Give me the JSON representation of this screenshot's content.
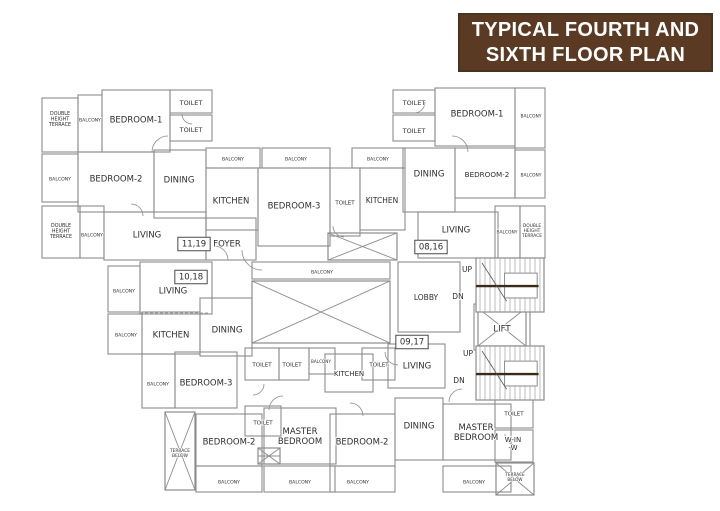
{
  "title": {
    "line1": "TYPICAL FOURTH AND",
    "line2": "SIXTH FLOOR PLAN",
    "bg": "#5a3a22",
    "fg": "#ffffff"
  },
  "plan": {
    "colors": {
      "wall": "#8c8c8c",
      "hatch": "#a3a3a3",
      "text": "#2e2e2e",
      "landing": "#3e2b17",
      "box_border": "#4a4a4a"
    },
    "rooms": [
      {
        "n": "tl-terrace-1",
        "r": [
          42,
          98,
          36,
          54
        ]
      },
      {
        "n": "tl-balcony-1",
        "r": [
          78,
          95,
          24,
          57
        ]
      },
      {
        "n": "tl-bedroom-1",
        "r": [
          102,
          90,
          68,
          62
        ]
      },
      {
        "n": "tl-toilet-1",
        "r": [
          170,
          90,
          42,
          23
        ]
      },
      {
        "n": "tl-toilet-2",
        "r": [
          170,
          115,
          42,
          26
        ]
      },
      {
        "n": "tl-balcony-2",
        "r": [
          42,
          154,
          36,
          48
        ]
      },
      {
        "n": "tl-bedroom-2",
        "r": [
          78,
          152,
          76,
          60
        ]
      },
      {
        "n": "tl-dining",
        "r": [
          154,
          150,
          52,
          68
        ]
      },
      {
        "n": "tl-living",
        "r": [
          104,
          212,
          102,
          48
        ]
      },
      {
        "n": "tl-terrace-2",
        "r": [
          42,
          206,
          38,
          52
        ]
      },
      {
        "n": "tl-balcony-3",
        "r": [
          80,
          206,
          24,
          52
        ]
      },
      {
        "n": "tl-foyer",
        "r": [
          206,
          218,
          50,
          42
        ]
      },
      {
        "n": "c-balcony-1",
        "r": [
          206,
          148,
          54,
          20
        ]
      },
      {
        "n": "c-balcony-2",
        "r": [
          262,
          148,
          68,
          20
        ]
      },
      {
        "n": "c-kitchen",
        "r": [
          206,
          168,
          52,
          62
        ]
      },
      {
        "n": "c-bedroom-3",
        "r": [
          258,
          168,
          72,
          78
        ]
      },
      {
        "n": "c-toilet",
        "r": [
          330,
          168,
          30,
          68
        ]
      },
      {
        "n": "c-kitchen-2",
        "r": [
          360,
          168,
          45,
          62
        ]
      },
      {
        "n": "c-balcony-3",
        "r": [
          352,
          148,
          53,
          20
        ]
      },
      {
        "n": "r-toilet-1",
        "r": [
          393,
          90,
          42,
          23
        ]
      },
      {
        "n": "r-toilet-2",
        "r": [
          393,
          115,
          42,
          26
        ]
      },
      {
        "n": "r-bedroom-1",
        "r": [
          435,
          88,
          80,
          58
        ]
      },
      {
        "n": "r-balcony-1",
        "r": [
          515,
          88,
          30,
          60
        ]
      },
      {
        "n": "r-dining",
        "r": [
          403,
          148,
          52,
          64
        ]
      },
      {
        "n": "r-bedroom-2",
        "r": [
          455,
          148,
          60,
          50
        ]
      },
      {
        "n": "r-balcony-2",
        "r": [
          515,
          150,
          30,
          48
        ]
      },
      {
        "n": "r-living",
        "r": [
          418,
          212,
          80,
          46
        ]
      },
      {
        "n": "r-balcony-3",
        "r": [
          495,
          206,
          25,
          52
        ]
      },
      {
        "n": "r-terrace",
        "r": [
          520,
          206,
          25,
          52
        ]
      },
      {
        "n": "core-lobby",
        "r": [
          398,
          262,
          62,
          70
        ]
      },
      {
        "n": "core-lift-outer",
        "r": [
          474,
          304,
          56,
          46
        ]
      },
      {
        "n": "c-balcony-4",
        "r": [
          252,
          262,
          138,
          17
        ]
      },
      {
        "n": "ll-balcony-1",
        "r": [
          108,
          266,
          32,
          46
        ]
      },
      {
        "n": "ll-living",
        "r": [
          140,
          262,
          72,
          52
        ]
      },
      {
        "n": "ll-balcony-2",
        "r": [
          108,
          314,
          34,
          40
        ]
      },
      {
        "n": "ll-kitchen",
        "r": [
          142,
          312,
          58,
          42
        ]
      },
      {
        "n": "ll-dining",
        "r": [
          200,
          298,
          52,
          58
        ]
      },
      {
        "n": "ll-balcony-3",
        "r": [
          142,
          354,
          33,
          54
        ]
      },
      {
        "n": "ll-bedroom-3",
        "r": [
          175,
          352,
          62,
          56
        ]
      },
      {
        "n": "lm-toilet-1",
        "r": [
          245,
          348,
          34,
          32
        ]
      },
      {
        "n": "lm-toilet-2",
        "r": [
          279,
          348,
          30,
          32
        ]
      },
      {
        "n": "lm-balcony",
        "r": [
          309,
          348,
          26,
          26
        ]
      },
      {
        "n": "lm-kitchen",
        "r": [
          325,
          354,
          48,
          38
        ]
      },
      {
        "n": "lm-toilet-3",
        "r": [
          362,
          348,
          33,
          32
        ]
      },
      {
        "n": "lm-living",
        "r": [
          388,
          344,
          57,
          44
        ]
      },
      {
        "n": "lm-toilet-4",
        "r": [
          245,
          406,
          36,
          30
        ]
      },
      {
        "n": "b-bedroom-2-l",
        "r": [
          196,
          414,
          66,
          52
        ]
      },
      {
        "n": "b-master-l",
        "r": [
          264,
          408,
          72,
          56
        ]
      },
      {
        "n": "b-bedroom-2-m",
        "r": [
          330,
          414,
          65,
          52
        ]
      },
      {
        "n": "b-dining",
        "r": [
          395,
          398,
          48,
          62
        ]
      },
      {
        "n": "b-master-r",
        "r": [
          443,
          404,
          68,
          56
        ]
      },
      {
        "n": "b-toilet",
        "r": [
          495,
          398,
          38,
          30
        ]
      },
      {
        "n": "b-winw",
        "r": [
          495,
          430,
          38,
          32
        ]
      },
      {
        "n": "b-balcony-1",
        "r": [
          196,
          466,
          66,
          26
        ]
      },
      {
        "n": "b-balcony-2",
        "r": [
          264,
          466,
          71,
          26
        ]
      },
      {
        "n": "b-balcony-3",
        "r": [
          330,
          466,
          65,
          26
        ]
      },
      {
        "n": "b-balcony-4",
        "r": [
          443,
          466,
          68,
          26
        ]
      }
    ],
    "crosses": [
      {
        "n": "duct-shaft-cross",
        "r": [
          328,
          233,
          69,
          27
        ],
        "mid": false
      },
      {
        "n": "courtyard-cross",
        "r": [
          252,
          281,
          138,
          62
        ],
        "mid": false
      },
      {
        "n": "lift-cross",
        "r": [
          478,
          308,
          48,
          38
        ],
        "mid": false
      },
      {
        "n": "terrace-below-left-cross",
        "r": [
          165,
          412,
          30,
          78
        ],
        "mid": false
      },
      {
        "n": "terrace-below-right-cross",
        "r": [
          496,
          463,
          38,
          32
        ],
        "mid": false
      },
      {
        "n": "small-shaft-cross",
        "r": [
          258,
          448,
          22,
          16
        ],
        "mid": true
      }
    ],
    "stairs": [
      {
        "n": "stair-upper",
        "r": [
          476,
          258,
          68,
          54
        ]
      },
      {
        "n": "stair-lower",
        "r": [
          476,
          346,
          68,
          54
        ]
      }
    ],
    "doors": [
      {
        "a": [
          168,
          152,
          16,
          180,
          270
        ]
      },
      {
        "a": [
          452,
          152,
          16,
          270,
          360
        ]
      },
      {
        "a": [
          262,
          250,
          20,
          90,
          180
        ]
      },
      {
        "a": [
          214,
          260,
          14,
          270,
          360
        ]
      },
      {
        "a": [
          344,
          226,
          11,
          90,
          180
        ]
      },
      {
        "a": [
          414,
          102,
          11,
          0,
          90
        ]
      },
      {
        "a": [
          192,
          114,
          10,
          90,
          180
        ]
      },
      {
        "a": [
          283,
          410,
          14,
          180,
          270
        ]
      },
      {
        "a": [
          350,
          416,
          13,
          270,
          360
        ]
      },
      {
        "a": [
          462,
          402,
          13,
          180,
          270
        ]
      },
      {
        "a": [
          516,
          434,
          11,
          90,
          180
        ]
      },
      {
        "a": [
          253,
          384,
          11,
          0,
          90
        ]
      },
      {
        "a": [
          398,
          352,
          13,
          90,
          180
        ]
      },
      {
        "a": [
          131,
          216,
          12,
          270,
          360
        ]
      }
    ],
    "dashlines": [
      [
        196,
        466,
        395,
        466
      ],
      [
        443,
        466,
        511,
        466
      ],
      [
        252,
        279,
        390,
        279
      ],
      [
        140,
        313,
        210,
        313
      ]
    ],
    "labels": [
      {
        "n": "tl-terrace-1-label",
        "lines": [
          "DOUBLE",
          "HEIGHT",
          "TERRACE"
        ],
        "x": 60,
        "y": 113,
        "fs": 4.8
      },
      {
        "n": "tl-balcony-1-label",
        "t": "BALCONY",
        "x": 90,
        "y": 120,
        "fs": 4.6
      },
      {
        "n": "tl-bedroom-1-label",
        "t": "BEDROOM-1",
        "x": 136,
        "y": 120,
        "fs": 8.5
      },
      {
        "n": "tl-toilet-1-label",
        "t": "TOILET",
        "x": 191,
        "y": 103,
        "fs": 6.5
      },
      {
        "n": "tl-toilet-2-label",
        "t": "TOILET",
        "x": 191,
        "y": 130,
        "fs": 6.5
      },
      {
        "n": "tl-balcony-2-label",
        "t": "BALCONY",
        "x": 60,
        "y": 179,
        "fs": 4.6
      },
      {
        "n": "tl-bedroom-2-label",
        "t": "BEDROOM-2",
        "x": 116,
        "y": 179,
        "fs": 8.5
      },
      {
        "n": "tl-dining-label",
        "t": "DINING",
        "x": 179,
        "y": 180,
        "fs": 8.5
      },
      {
        "n": "tl-living-label",
        "t": "LIVING",
        "x": 147,
        "y": 235,
        "fs": 8.5
      },
      {
        "n": "tl-terrace-2-label",
        "lines": [
          "DOUBLE",
          "HEIGHT",
          "TERRACE"
        ],
        "x": 61,
        "y": 225,
        "fs": 4.8
      },
      {
        "n": "tl-balcony-3-label",
        "t": "BALCONY",
        "x": 92,
        "y": 235,
        "fs": 4.6
      },
      {
        "n": "unit-11-19",
        "t": "11,19",
        "x": 194,
        "y": 244,
        "fs": 8.5,
        "boxed": true
      },
      {
        "n": "tl-foyer-label",
        "t": "FOYER",
        "x": 227,
        "y": 244,
        "fs": 8.5
      },
      {
        "n": "c-balcony-1-label",
        "t": "BALCONY",
        "x": 233,
        "y": 159,
        "fs": 4.6
      },
      {
        "n": "c-balcony-2-label",
        "t": "BALCONY",
        "x": 296,
        "y": 159,
        "fs": 4.6
      },
      {
        "n": "c-kitchen-label",
        "t": "KITCHEN",
        "x": 231,
        "y": 201,
        "fs": 8.5
      },
      {
        "n": "c-bedroom-3-label",
        "t": "BEDROOM-3",
        "x": 294,
        "y": 206,
        "fs": 8.5
      },
      {
        "n": "c-toilet-label",
        "t": "TOILET",
        "x": 345,
        "y": 203,
        "fs": 5.5
      },
      {
        "n": "c-kitchen-2-label",
        "t": "KITCHEN",
        "x": 382,
        "y": 201,
        "fs": 7.5
      },
      {
        "n": "c-balcony-3-label",
        "t": "BALCONY",
        "x": 378,
        "y": 159,
        "fs": 4.6
      },
      {
        "n": "r-toilet-1-label",
        "t": "TOILET",
        "x": 414,
        "y": 103,
        "fs": 6.5
      },
      {
        "n": "r-toilet-2-label",
        "t": "TOILET",
        "x": 414,
        "y": 131,
        "fs": 6.5
      },
      {
        "n": "r-bedroom-1-label",
        "t": "BEDROOM-1",
        "x": 477,
        "y": 114,
        "fs": 8.5
      },
      {
        "n": "r-balcony-1-label",
        "t": "BALCONY",
        "x": 531,
        "y": 116,
        "fs": 4.4
      },
      {
        "n": "r-dining-label",
        "t": "DINING",
        "x": 429,
        "y": 174,
        "fs": 8.5
      },
      {
        "n": "r-bedroom-2-label",
        "t": "BEDROOM-2",
        "x": 487,
        "y": 175,
        "fs": 7.2
      },
      {
        "n": "r-balcony-2-label",
        "t": "BALCONY",
        "x": 531,
        "y": 175,
        "fs": 4.4
      },
      {
        "n": "r-living-label",
        "t": "LIVING",
        "x": 456,
        "y": 230,
        "fs": 8.5
      },
      {
        "n": "unit-08-16",
        "t": "08,16",
        "x": 431,
        "y": 247,
        "fs": 8.5,
        "boxed": true
      },
      {
        "n": "r-balcony-3-label",
        "t": "BALCONY",
        "x": 507,
        "y": 232,
        "fs": 4.4
      },
      {
        "n": "r-terrace-label",
        "lines": [
          "DOUBLE",
          "HEIGHT",
          "TERRACE"
        ],
        "x": 532,
        "y": 225,
        "fs": 4.4
      },
      {
        "n": "stair-upper-up-label",
        "t": "UP",
        "x": 467,
        "y": 270,
        "fs": 7.5
      },
      {
        "n": "stair-upper-dn-label",
        "t": "DN",
        "x": 458,
        "y": 297,
        "fs": 7.5
      },
      {
        "n": "core-lobby-label",
        "t": "LOBBY",
        "x": 426,
        "y": 298,
        "fs": 7.5
      },
      {
        "n": "core-lift-label",
        "t": "LIFT",
        "x": 502,
        "y": 329,
        "fs": 8.5
      },
      {
        "n": "stair-lower-up-label",
        "t": "UP",
        "x": 468,
        "y": 354,
        "fs": 7.5
      },
      {
        "n": "stair-lower-dn-label",
        "t": "DN",
        "x": 459,
        "y": 381,
        "fs": 7.5
      },
      {
        "n": "c-balcony-4-label",
        "t": "BALCONY",
        "x": 322,
        "y": 272,
        "fs": 4.6
      },
      {
        "n": "ll-balcony-1-label",
        "t": "BALCONY",
        "x": 124,
        "y": 291,
        "fs": 4.6
      },
      {
        "n": "ll-living-label",
        "t": "LIVING",
        "x": 173,
        "y": 291,
        "fs": 8.5
      },
      {
        "n": "unit-10-18",
        "t": "10,18",
        "x": 191,
        "y": 277,
        "fs": 8.5,
        "boxed": true
      },
      {
        "n": "ll-balcony-2-label",
        "t": "BALCONY",
        "x": 126,
        "y": 335,
        "fs": 4.6
      },
      {
        "n": "ll-kitchen-label",
        "t": "KITCHEN",
        "x": 171,
        "y": 335,
        "fs": 8.5
      },
      {
        "n": "ll-dining-label",
        "t": "DINING",
        "x": 227,
        "y": 330,
        "fs": 8.5
      },
      {
        "n": "ll-balcony-3-label",
        "t": "BALCONY",
        "x": 158,
        "y": 384,
        "fs": 4.6
      },
      {
        "n": "ll-bedroom-3-label",
        "t": "BEDROOM-3",
        "x": 206,
        "y": 383,
        "fs": 8.5
      },
      {
        "n": "lm-toilet-1-label",
        "t": "TOILET",
        "x": 262,
        "y": 365,
        "fs": 5.5
      },
      {
        "n": "lm-toilet-2-label",
        "t": "TOILET",
        "x": 292,
        "y": 365,
        "fs": 5.5
      },
      {
        "n": "lm-balcony-label",
        "t": "BALCONY",
        "x": 321,
        "y": 362,
        "fs": 4.2
      },
      {
        "n": "lm-kitchen-label",
        "t": "KITCHEN",
        "x": 349,
        "y": 374,
        "fs": 7
      },
      {
        "n": "lm-toilet-3-label",
        "t": "TOILET",
        "x": 379,
        "y": 365,
        "fs": 5.5
      },
      {
        "n": "unit-09-17",
        "t": "09,17",
        "x": 412,
        "y": 342,
        "fs": 8.5,
        "boxed": true
      },
      {
        "n": "lm-living-label",
        "t": "LIVING",
        "x": 417,
        "y": 366,
        "fs": 8.5
      },
      {
        "n": "lm-toilet-4-label",
        "t": "TOILET",
        "x": 263,
        "y": 423,
        "fs": 5.5
      },
      {
        "n": "b-terrace-l-label",
        "lines": [
          "TERRACE",
          "BELOW"
        ],
        "x": 180,
        "y": 450,
        "fs": 4.4
      },
      {
        "n": "b-bedroom-2-l-label",
        "t": "BEDROOM-2",
        "x": 229,
        "y": 442,
        "fs": 8.5
      },
      {
        "n": "b-master-l-label",
        "lines": [
          "MASTER",
          "BEDROOM"
        ],
        "x": 300,
        "y": 431,
        "fs": 8.5
      },
      {
        "n": "b-bedroom-2-m-label",
        "t": "BEDROOM-2",
        "x": 362,
        "y": 442,
        "fs": 8.5
      },
      {
        "n": "b-dining-label",
        "t": "DINING",
        "x": 419,
        "y": 426,
        "fs": 8.5
      },
      {
        "n": "b-master-r-label",
        "lines": [
          "MASTER",
          "BEDROOM"
        ],
        "x": 476,
        "y": 427,
        "fs": 8.5
      },
      {
        "n": "b-toilet-label",
        "t": "TOILET",
        "x": 514,
        "y": 414,
        "fs": 5.5
      },
      {
        "n": "b-winw-label",
        "lines": [
          "W-IN",
          "-W"
        ],
        "x": 513,
        "y": 440,
        "fs": 7
      },
      {
        "n": "b-terrace-r-label",
        "lines": [
          "TERRACE",
          "BELOW"
        ],
        "x": 515,
        "y": 475,
        "fs": 4.2
      },
      {
        "n": "b-balcony-1-label",
        "t": "BALCONY",
        "x": 229,
        "y": 482,
        "fs": 4.6
      },
      {
        "n": "b-balcony-2-label",
        "t": "BALCONY",
        "x": 300,
        "y": 482,
        "fs": 4.6
      },
      {
        "n": "b-balcony-3-label",
        "t": "BALCONY",
        "x": 358,
        "y": 482,
        "fs": 4.6
      },
      {
        "n": "b-balcony-4-label",
        "t": "BALCONY",
        "x": 474,
        "y": 482,
        "fs": 4.6
      }
    ]
  }
}
